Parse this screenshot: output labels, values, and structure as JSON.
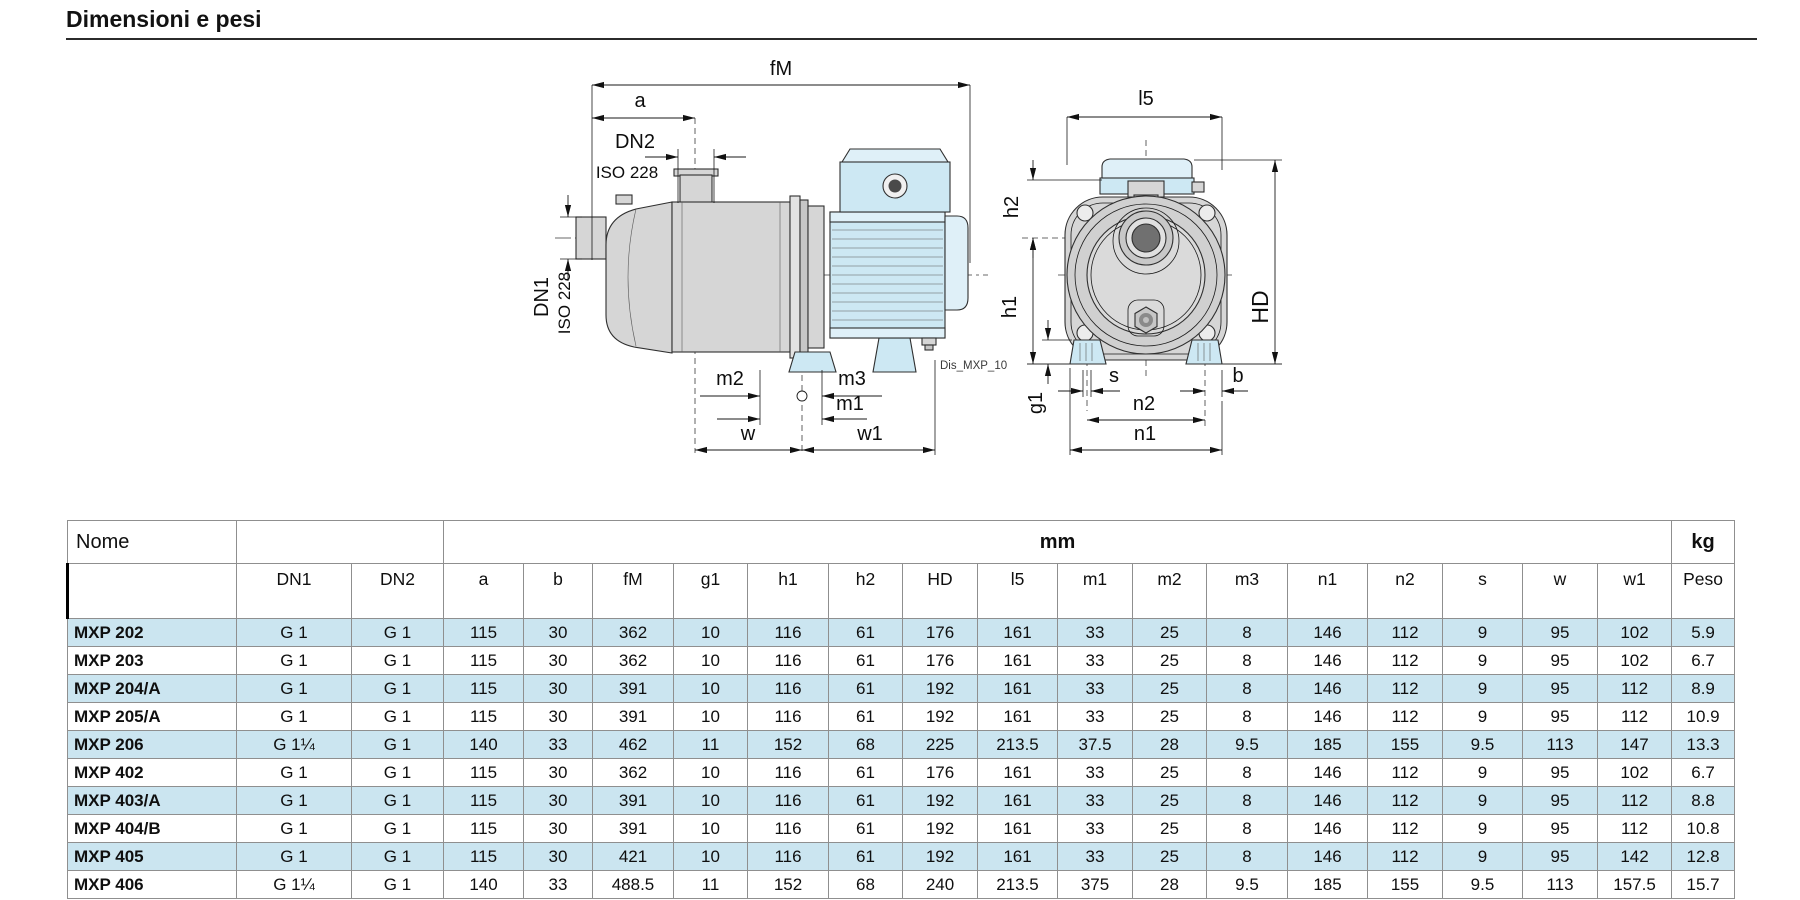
{
  "page": {
    "title": "Dimensioni e pesi"
  },
  "drawing": {
    "caption": "Dis_MXP_10",
    "labels": {
      "fM": "fM",
      "a": "a",
      "dn2": "DN2",
      "iso228a": "ISO 228",
      "dn1": "DN1",
      "iso228b": "ISO 228",
      "m2": "m2",
      "m3": "m3",
      "m1": "m1",
      "w": "w",
      "w1": "w1",
      "l5": "l5",
      "h2": "h2",
      "h1": "h1",
      "hd": "HD",
      "g1": "g1",
      "s": "s",
      "b": "b",
      "n2": "n2",
      "n1": "n1"
    }
  },
  "table": {
    "corner_label": "Nome",
    "unit_mm": "mm",
    "unit_kg": "kg",
    "weight_label": "Peso",
    "columns": [
      "DN1",
      "DN2",
      "a",
      "b",
      "fM",
      "g1",
      "h1",
      "h2",
      "HD",
      "l5",
      "m1",
      "m2",
      "m3",
      "n1",
      "n2",
      "s",
      "w",
      "w1"
    ],
    "rows": [
      {
        "name": "MXP 202",
        "highlight": true,
        "cells": [
          "G 1",
          "G 1",
          "115",
          "30",
          "362",
          "10",
          "116",
          "61",
          "176",
          "161",
          "33",
          "25",
          "8",
          "146",
          "112",
          "9",
          "95",
          "102",
          "5.9"
        ]
      },
      {
        "name": "MXP 203",
        "highlight": false,
        "cells": [
          "G 1",
          "G 1",
          "115",
          "30",
          "362",
          "10",
          "116",
          "61",
          "176",
          "161",
          "33",
          "25",
          "8",
          "146",
          "112",
          "9",
          "95",
          "102",
          "6.7"
        ]
      },
      {
        "name": "MXP 204/A",
        "highlight": true,
        "cells": [
          "G 1",
          "G 1",
          "115",
          "30",
          "391",
          "10",
          "116",
          "61",
          "192",
          "161",
          "33",
          "25",
          "8",
          "146",
          "112",
          "9",
          "95",
          "112",
          "8.9"
        ]
      },
      {
        "name": "MXP 205/A",
        "highlight": false,
        "cells": [
          "G 1",
          "G 1",
          "115",
          "30",
          "391",
          "10",
          "116",
          "61",
          "192",
          "161",
          "33",
          "25",
          "8",
          "146",
          "112",
          "9",
          "95",
          "112",
          "10.9"
        ]
      },
      {
        "name": "MXP 206",
        "highlight": true,
        "cells": [
          "G 1¼",
          "G 1",
          "140",
          "33",
          "462",
          "11",
          "152",
          "68",
          "225",
          "213.5",
          "37.5",
          "28",
          "9.5",
          "185",
          "155",
          "9.5",
          "113",
          "147",
          "13.3"
        ]
      },
      {
        "name": "MXP 402",
        "highlight": false,
        "cells": [
          "G 1",
          "G 1",
          "115",
          "30",
          "362",
          "10",
          "116",
          "61",
          "176",
          "161",
          "33",
          "25",
          "8",
          "146",
          "112",
          "9",
          "95",
          "102",
          "6.7"
        ]
      },
      {
        "name": "MXP 403/A",
        "highlight": true,
        "cells": [
          "G 1",
          "G 1",
          "115",
          "30",
          "391",
          "10",
          "116",
          "61",
          "192",
          "161",
          "33",
          "25",
          "8",
          "146",
          "112",
          "9",
          "95",
          "112",
          "8.8"
        ]
      },
      {
        "name": "MXP 404/B",
        "highlight": false,
        "cells": [
          "G 1",
          "G 1",
          "115",
          "30",
          "391",
          "10",
          "116",
          "61",
          "192",
          "161",
          "33",
          "25",
          "8",
          "146",
          "112",
          "9",
          "95",
          "112",
          "10.8"
        ]
      },
      {
        "name": "MXP 405",
        "highlight": true,
        "cells": [
          "G 1",
          "G 1",
          "115",
          "30",
          "421",
          "10",
          "116",
          "61",
          "192",
          "161",
          "33",
          "25",
          "8",
          "146",
          "112",
          "9",
          "95",
          "142",
          "12.8"
        ]
      },
      {
        "name": "MXP 406",
        "highlight": false,
        "cells": [
          "G 1¼",
          "G 1",
          "140",
          "33",
          "488.5",
          "11",
          "152",
          "68",
          "240",
          "213.5",
          "375",
          "28",
          "9.5",
          "185",
          "155",
          "9.5",
          "113",
          "157.5",
          "15.7"
        ]
      }
    ]
  },
  "colors": {
    "row_highlight": "#cbe5f0",
    "motor_blue": "#cde8f3",
    "motor_blue_light": "#dff0f8",
    "body_gray": "#d6d6d6",
    "line": "#2f2f2f"
  }
}
